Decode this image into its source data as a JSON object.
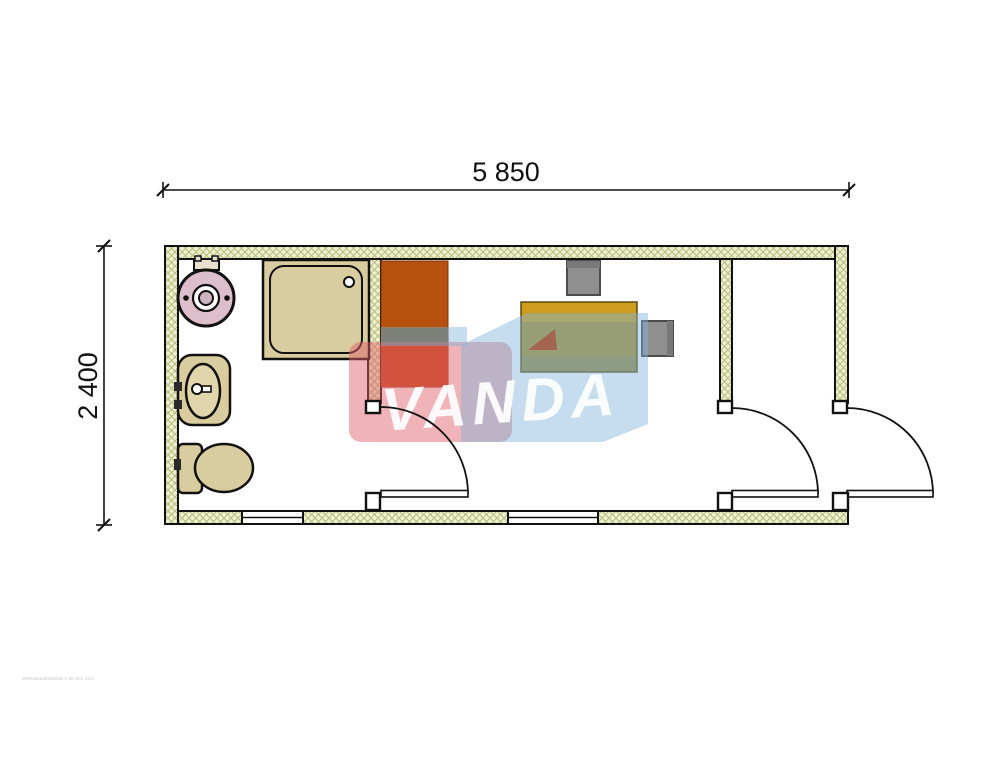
{
  "document": {
    "type": "architectural-floor-plan",
    "dimensions": {
      "width_label": "5 850",
      "height_label": "2 400"
    },
    "watermark": {
      "brand": "VANDA",
      "colors": {
        "blue": "#7fb3d9",
        "pink": "#e0606a",
        "red_accent": "#b03430",
        "letters": "#ffffff"
      }
    },
    "fine_print": "SWRelatedSchedule A 95 HCL VC5",
    "colors": {
      "wall_fill": "#eef0cf",
      "wall_hatch": "#b6bd7e",
      "outline": "#111111",
      "fixture_tan": "#d9cc9e",
      "basin_tan": "#e0d5ab",
      "boiler_pink": "#ddbecb",
      "wardrobe_orange": "#b5500f",
      "wardrobe_red": "#c84318",
      "desk_gold": "#cf9d1d",
      "desk_olive": "#ab8d24",
      "chair_gray": "#8f8f8f"
    },
    "rooms": [
      {
        "name": "bathroom",
        "fixtures": [
          "water-heater",
          "shower-tray",
          "washbasin",
          "toilet"
        ]
      },
      {
        "name": "office",
        "fixtures": [
          "wardrobe",
          "desk",
          "desk-chair",
          "side-chair"
        ]
      },
      {
        "name": "entry",
        "fixtures": []
      }
    ],
    "openings": {
      "doors": 3,
      "windows": 2
    }
  }
}
